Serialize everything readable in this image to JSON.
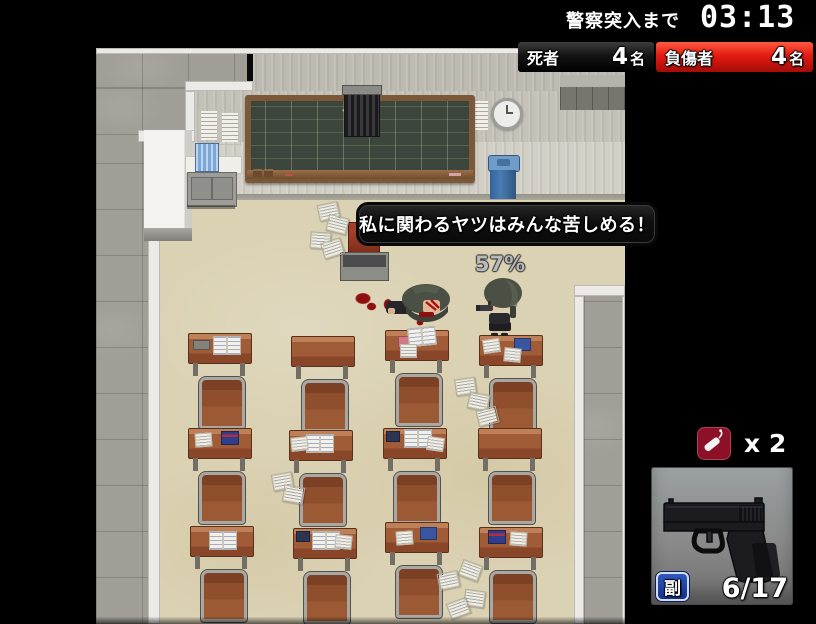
{
  "hud": {
    "timer": {
      "label": "警察突入まで",
      "value": "03:13"
    },
    "deaths": {
      "label": "死者",
      "value": "4",
      "unit": "名"
    },
    "injured": {
      "label": "負傷者",
      "value": "4",
      "unit": "名"
    },
    "item_counter": {
      "icon": "explosive-item-icon",
      "label": "x 2"
    },
    "weapon": {
      "icon": "pistol-image",
      "slot_badge": "副",
      "ammo": "6/17"
    }
  },
  "dialogue": {
    "speech": "私に関わるヤツはみんな苦しめる！"
  },
  "battle": {
    "hit_chance": "57%"
  },
  "colors": {
    "hud_black": "#0b0b0b",
    "injured_red": "#e31b12",
    "item_icon_maroon": "#8c1028",
    "badge_blue": "#1e4bb8",
    "panel_gray": "#8a8a8a",
    "floor_cream": "#dbd2b4",
    "corridor_gray": "#a09e96",
    "blackboard_green": "#3c463c"
  },
  "map": {
    "player": {
      "x": 380,
      "y": 230
    },
    "victim": {
      "x": 290,
      "y": 236
    },
    "desks": [
      {
        "x": 92,
        "y": 285,
        "items": [
          {
            "t": "case",
            "dx": 4,
            "dy": 6
          },
          {
            "t": "book",
            "dx": 24,
            "dy": 2
          }
        ]
      },
      {
        "x": 195,
        "y": 288,
        "items": []
      },
      {
        "x": 289,
        "y": 282,
        "items": [
          {
            "t": "pink",
            "dx": 12,
            "dy": 5
          },
          {
            "t": "book",
            "dx": 22,
            "dy": -4,
            "rot": -6
          },
          {
            "t": "paper",
            "dx": 14,
            "dy": 13
          }
        ]
      },
      {
        "x": 383,
        "y": 287,
        "items": [
          {
            "t": "paper",
            "dx": 3,
            "dy": 3,
            "rot": -8
          },
          {
            "t": "blue",
            "dx": 34,
            "dy": 2
          },
          {
            "t": "paper",
            "dx": 24,
            "dy": 12,
            "rot": 6
          }
        ]
      },
      {
        "x": 92,
        "y": 380,
        "items": [
          {
            "t": "paper",
            "dx": 6,
            "dy": 4,
            "rot": -4
          },
          {
            "t": "flag",
            "dx": 32,
            "dy": 2
          }
        ]
      },
      {
        "x": 193,
        "y": 382,
        "items": [
          {
            "t": "book",
            "dx": 16,
            "dy": 3
          },
          {
            "t": "paper",
            "dx": 1,
            "dy": 6,
            "rot": -6
          }
        ]
      },
      {
        "x": 287,
        "y": 380,
        "items": [
          {
            "t": "dark",
            "dx": 2,
            "dy": 2
          },
          {
            "t": "book",
            "dx": 20,
            "dy": 0
          },
          {
            "t": "paper",
            "dx": 43,
            "dy": 8,
            "rot": 8
          }
        ]
      },
      {
        "x": 382,
        "y": 380,
        "items": []
      },
      {
        "x": 94,
        "y": 478,
        "items": [
          {
            "t": "book",
            "dx": 18,
            "dy": 4
          }
        ]
      },
      {
        "x": 197,
        "y": 480,
        "items": [
          {
            "t": "dark",
            "dx": 2,
            "dy": 2
          },
          {
            "t": "book",
            "dx": 18,
            "dy": 2
          },
          {
            "t": "paper",
            "dx": 41,
            "dy": 6,
            "rot": 6
          }
        ]
      },
      {
        "x": 289,
        "y": 474,
        "items": [
          {
            "t": "paper",
            "dx": 10,
            "dy": 8,
            "rot": -4
          },
          {
            "t": "blue",
            "dx": 34,
            "dy": 4
          }
        ]
      },
      {
        "x": 383,
        "y": 479,
        "items": [
          {
            "t": "flag",
            "dx": 8,
            "dy": 2
          },
          {
            "t": "paper",
            "dx": 30,
            "dy": 4,
            "rot": 4
          }
        ]
      }
    ],
    "papers": [
      {
        "x": 222,
        "y": 155,
        "rot": -12
      },
      {
        "x": 231,
        "y": 168,
        "rot": 14
      },
      {
        "x": 214,
        "y": 184,
        "rot": 4
      },
      {
        "x": 226,
        "y": 192,
        "rot": -18
      },
      {
        "x": 359,
        "y": 330,
        "rot": -8
      },
      {
        "x": 372,
        "y": 345,
        "rot": 12
      },
      {
        "x": 381,
        "y": 360,
        "rot": -14
      },
      {
        "x": 176,
        "y": 425,
        "rot": -10
      },
      {
        "x": 187,
        "y": 438,
        "rot": 10
      },
      {
        "x": 364,
        "y": 514,
        "rot": 20
      },
      {
        "x": 342,
        "y": 524,
        "rot": -12
      },
      {
        "x": 368,
        "y": 542,
        "rot": 8
      },
      {
        "x": 352,
        "y": 552,
        "rot": -20
      }
    ],
    "blood": [
      {
        "x": 258,
        "y": 244,
        "w": 18,
        "h": 13
      },
      {
        "x": 270,
        "y": 254,
        "w": 11,
        "h": 9
      },
      {
        "x": 287,
        "y": 250,
        "w": 10,
        "h": 13
      },
      {
        "x": 320,
        "y": 271,
        "w": 8,
        "h": 7
      }
    ]
  }
}
